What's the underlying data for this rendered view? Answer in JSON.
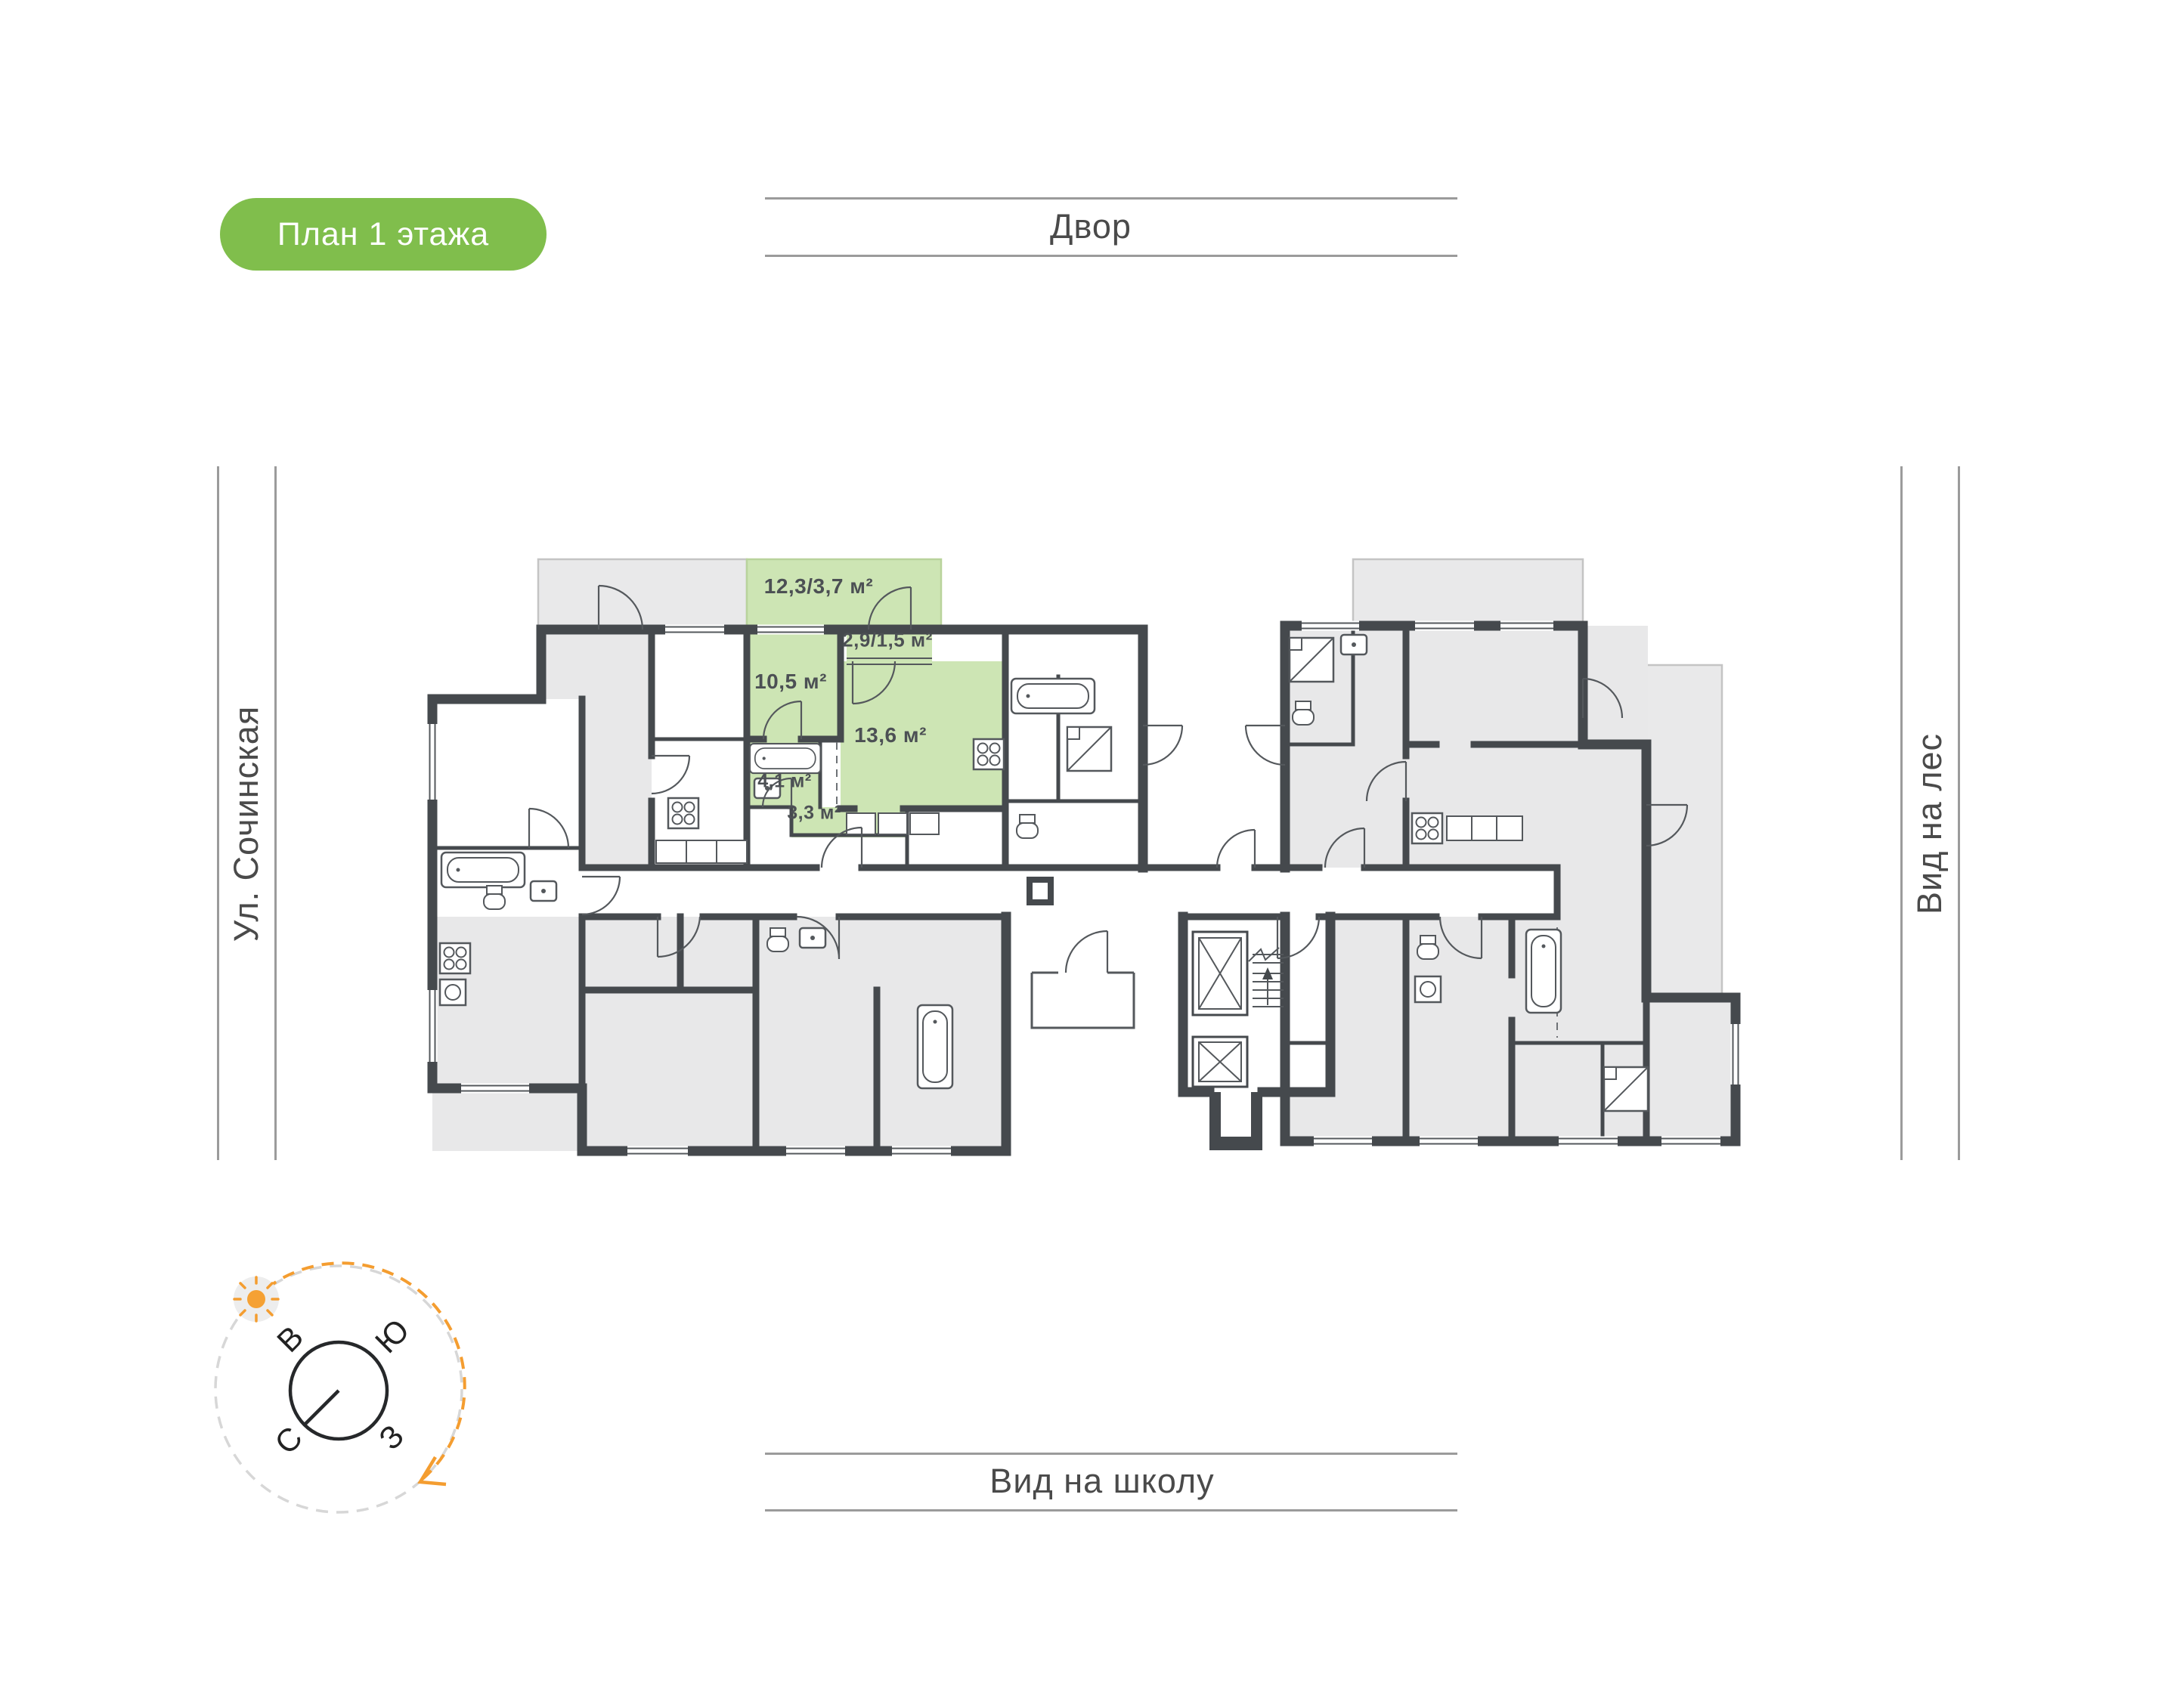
{
  "badge": {
    "label": "План 1 этажа"
  },
  "surroundings": {
    "top": {
      "label": "Двор"
    },
    "left": {
      "label": "Ул. Сочинская"
    },
    "right": {
      "label": "Вид на лес"
    },
    "bottom": {
      "label": "Вид на школу"
    }
  },
  "compass": {
    "north": "С",
    "south": "Ю",
    "east": "В",
    "west": "З"
  },
  "apartment": {
    "highlight_color": "#cde5b4",
    "rooms": [
      {
        "name": "terrace",
        "area": "12,3/3,7 м²"
      },
      {
        "name": "balcony",
        "area": "2,9/1,5 м²"
      },
      {
        "name": "room",
        "area": "10,5 м²"
      },
      {
        "name": "kitchen-living",
        "area": "13,6 м²"
      },
      {
        "name": "bathroom",
        "area": "4,1 м²"
      },
      {
        "name": "hallway",
        "area": "3,3 м²"
      }
    ]
  },
  "colors": {
    "badge_green": "#80be4c",
    "highlight_green": "#cde5b4",
    "wall": "#45494d",
    "room_gray": "#e8e8e9",
    "accent_orange": "#f49d30"
  }
}
